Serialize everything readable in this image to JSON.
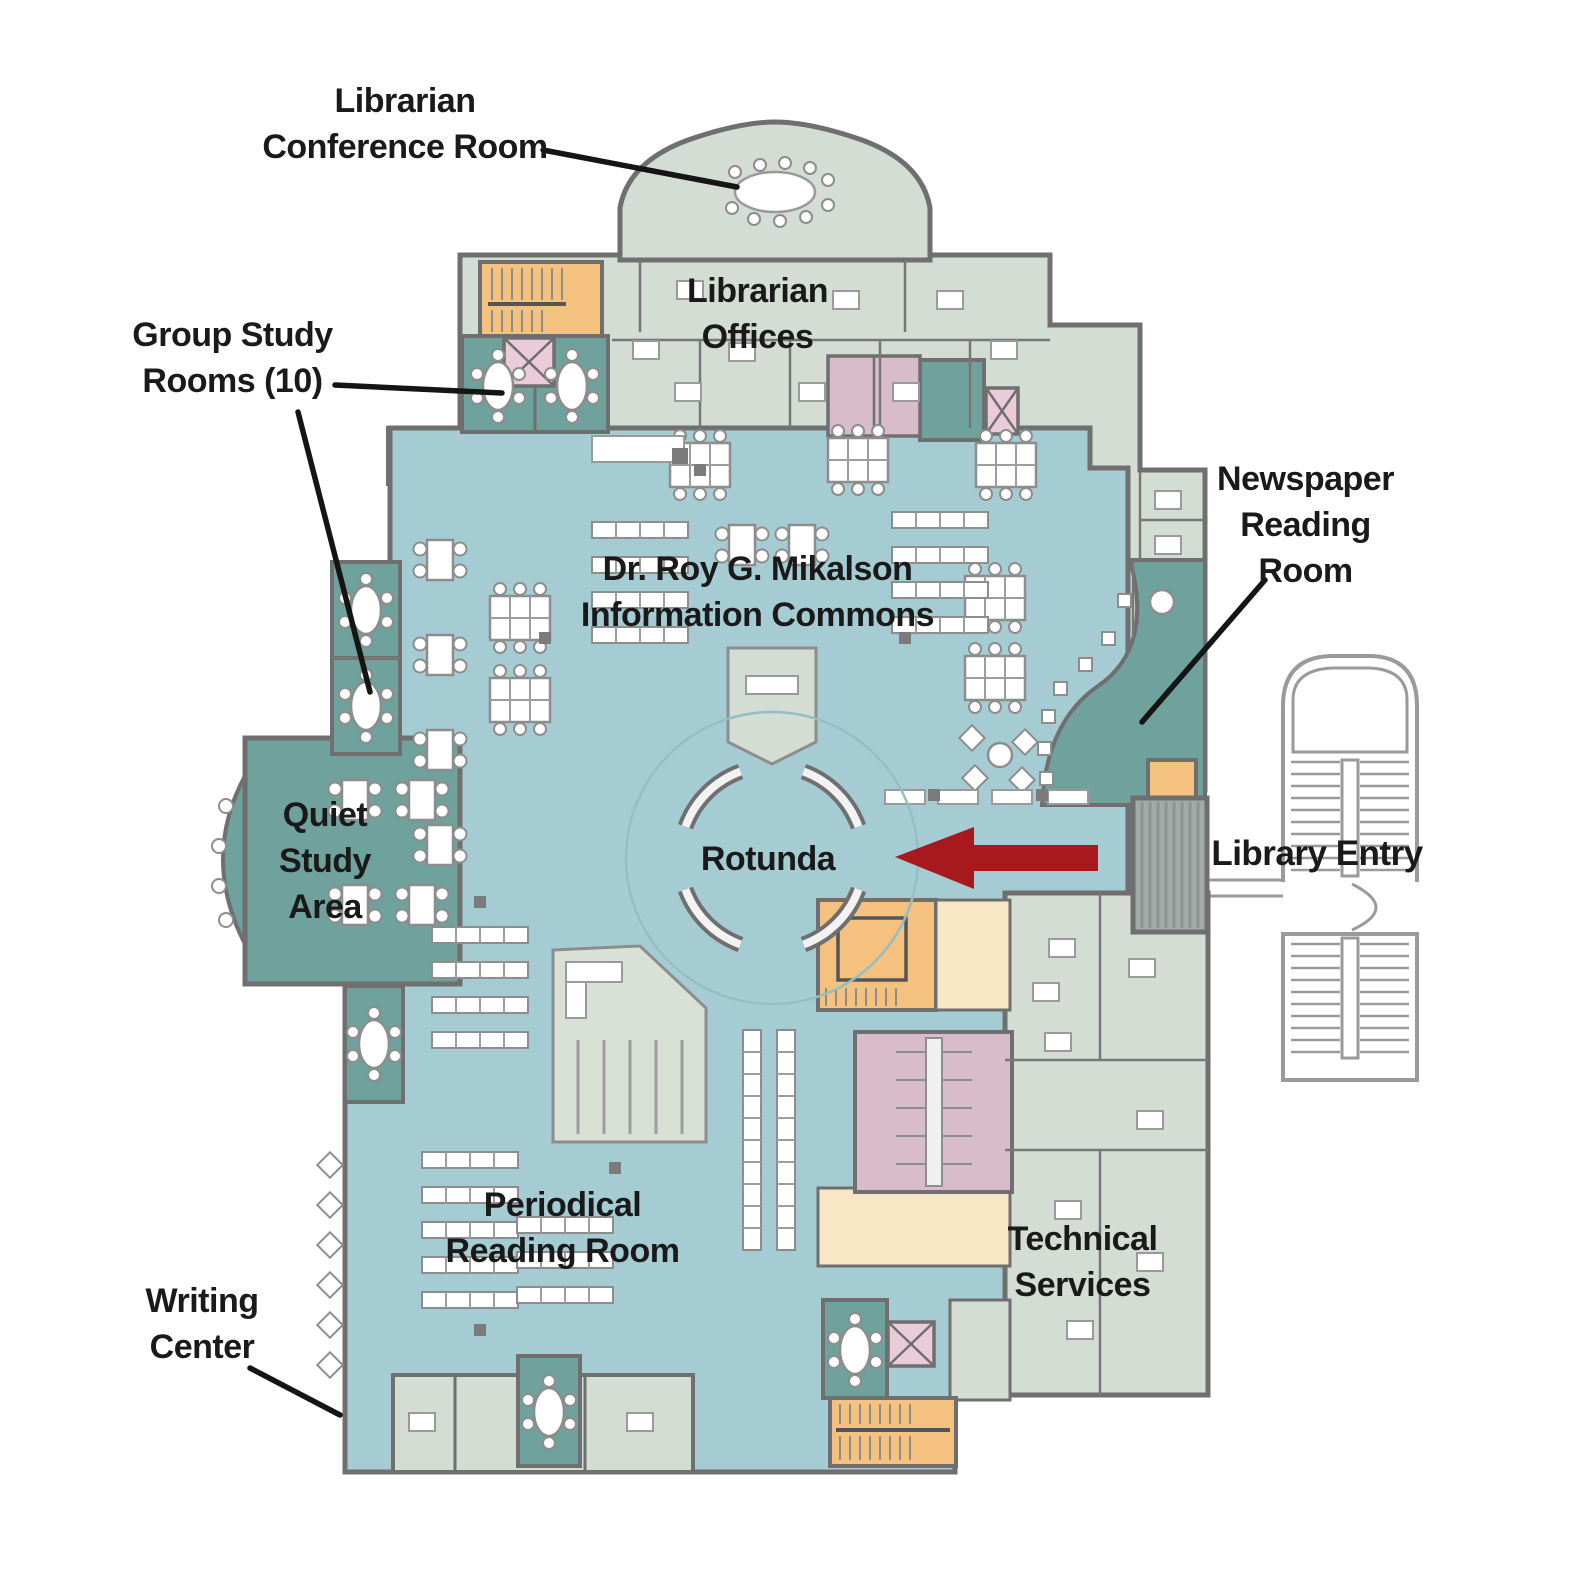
{
  "map": {
    "labels": {
      "librarian_conference_room": "Librarian\nConference Room",
      "group_study_rooms": "Group Study\nRooms (10)",
      "librarian_offices": "Librarian\nOffices",
      "newspaper_reading_room": "Newspaper\nReading\nRoom",
      "information_commons": "Dr. Roy G. Mikalson\nInformation Commons",
      "quiet_study_area": "Quiet\nStudy\nArea",
      "rotunda": "Rotunda",
      "library_entry": "Library Entry",
      "periodical_reading_room": "Periodical\nReading Room",
      "writing_center": "Writing\nCenter",
      "technical_services": "Technical\nServices"
    },
    "arrow": {
      "symbol": "left-arrow",
      "points_to": "Rotunda",
      "color": "#a8191d"
    },
    "palette": {
      "floor": "#a6ccd3",
      "study_rooms": "#6fa19d",
      "offices": "#d4ddd3",
      "stairs": "#f4c17e",
      "lobby": "#f8e6c4",
      "restrooms": "#d9bcc9",
      "elevator": "#e9ccd8",
      "walls": "#6f6f6f",
      "exterior_stairs": "#9a9a9a",
      "label_text": "#1a1a1a"
    }
  }
}
